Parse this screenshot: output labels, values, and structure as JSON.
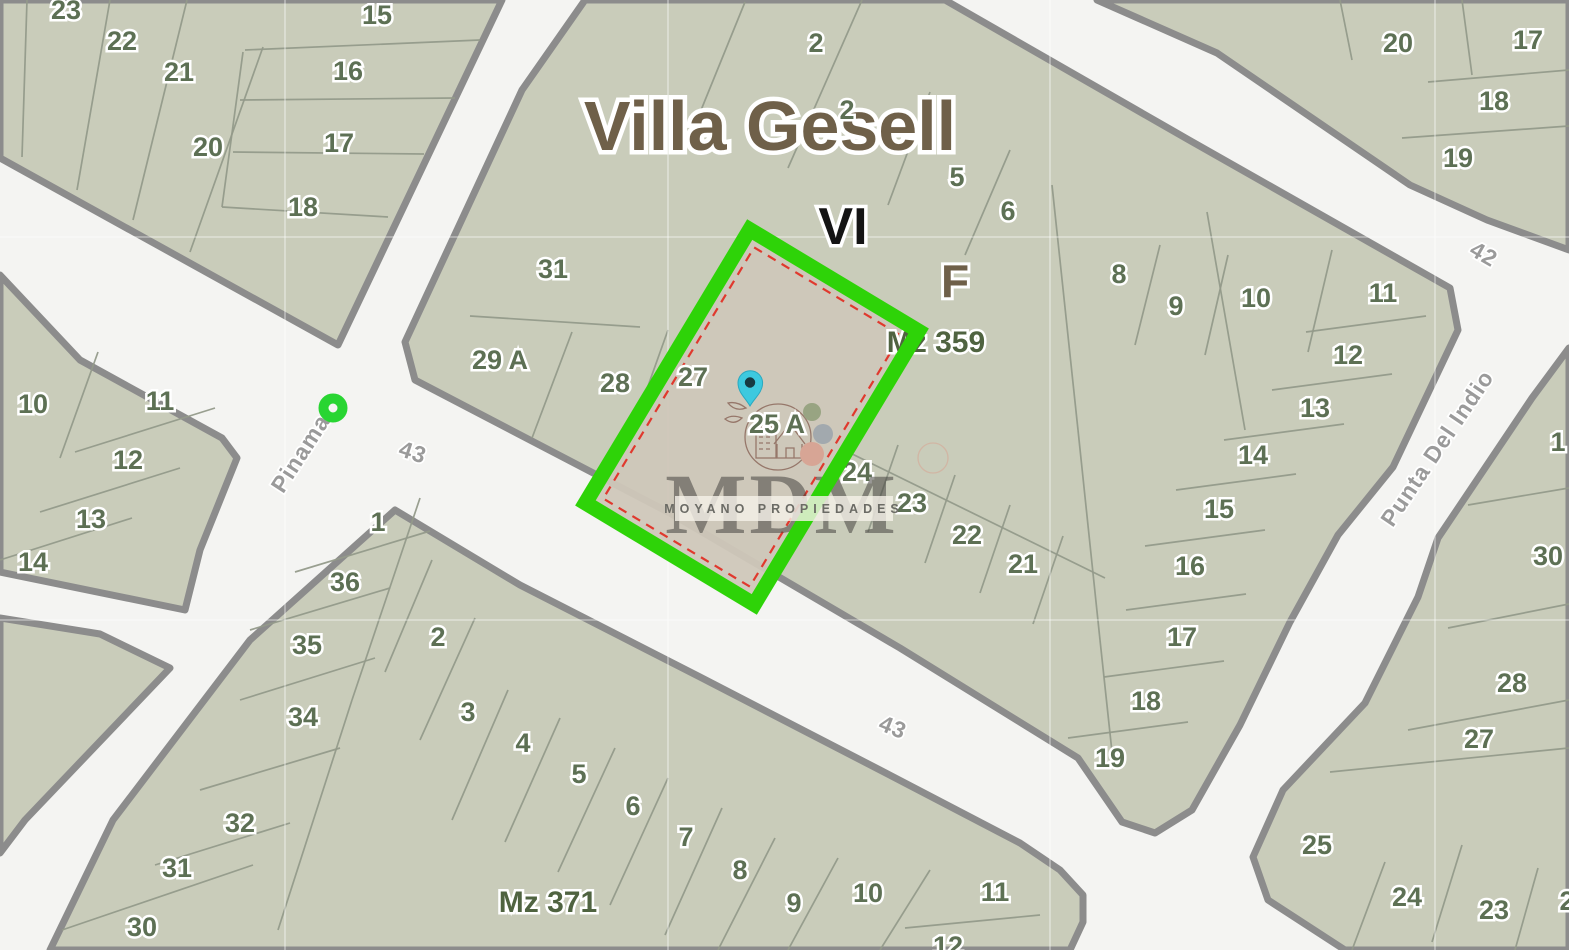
{
  "map": {
    "title": "Villa Gesell",
    "section_label": "VI",
    "subsection_label": "F",
    "block_labels": [
      {
        "text": "Mz 359",
        "x": 936,
        "y": 341
      },
      {
        "text": "Mz 371",
        "x": 548,
        "y": 901
      }
    ],
    "streets": [
      {
        "name": "Pinamar",
        "x": 303,
        "y": 449,
        "rot": -57
      },
      {
        "name": "43",
        "x": 413,
        "y": 452,
        "rot": 18
      },
      {
        "name": "43",
        "x": 893,
        "y": 727,
        "rot": 22
      },
      {
        "name": "42",
        "x": 1484,
        "y": 254,
        "rot": 30
      },
      {
        "name": "Punta Del Indio",
        "x": 1437,
        "y": 448,
        "rot": -56
      }
    ],
    "lots": [
      {
        "n": "23",
        "x": 66,
        "y": 10
      },
      {
        "n": "22",
        "x": 122,
        "y": 41
      },
      {
        "n": "21",
        "x": 179,
        "y": 72
      },
      {
        "n": "20",
        "x": 208,
        "y": 147
      },
      {
        "n": "18",
        "x": 303,
        "y": 207
      },
      {
        "n": "15",
        "x": 377,
        "y": 15
      },
      {
        "n": "16",
        "x": 348,
        "y": 71
      },
      {
        "n": "17",
        "x": 339,
        "y": 143
      },
      {
        "n": "20",
        "x": 1398,
        "y": 43
      },
      {
        "n": "17",
        "x": 1528,
        "y": 40
      },
      {
        "n": "18",
        "x": 1494,
        "y": 101
      },
      {
        "n": "19",
        "x": 1458,
        "y": 158
      },
      {
        "n": "2",
        "x": 816,
        "y": 43
      },
      {
        "n": "2",
        "x": 847,
        "y": 110
      },
      {
        "n": "5",
        "x": 957,
        "y": 177
      },
      {
        "n": "6",
        "x": 1008,
        "y": 211
      },
      {
        "n": "31",
        "x": 553,
        "y": 269
      },
      {
        "n": "29 A",
        "x": 500,
        "y": 360
      },
      {
        "n": "28",
        "x": 615,
        "y": 383
      },
      {
        "n": "27",
        "x": 693,
        "y": 377
      },
      {
        "n": "25 A",
        "x": 777,
        "y": 424
      },
      {
        "n": "24",
        "x": 857,
        "y": 472
      },
      {
        "n": "23",
        "x": 912,
        "y": 503
      },
      {
        "n": "22",
        "x": 967,
        "y": 535
      },
      {
        "n": "21",
        "x": 1023,
        "y": 564
      },
      {
        "n": "8",
        "x": 1119,
        "y": 274
      },
      {
        "n": "9",
        "x": 1176,
        "y": 306
      },
      {
        "n": "10",
        "x": 1256,
        "y": 298
      },
      {
        "n": "11",
        "x": 1383,
        "y": 293
      },
      {
        "n": "12",
        "x": 1348,
        "y": 355
      },
      {
        "n": "13",
        "x": 1315,
        "y": 408
      },
      {
        "n": "14",
        "x": 1253,
        "y": 455
      },
      {
        "n": "15",
        "x": 1219,
        "y": 509
      },
      {
        "n": "16",
        "x": 1190,
        "y": 566
      },
      {
        "n": "17",
        "x": 1182,
        "y": 637
      },
      {
        "n": "18",
        "x": 1146,
        "y": 701
      },
      {
        "n": "19",
        "x": 1110,
        "y": 758
      },
      {
        "n": "10",
        "x": 33,
        "y": 404
      },
      {
        "n": "11",
        "x": 160,
        "y": 401
      },
      {
        "n": "12",
        "x": 128,
        "y": 460
      },
      {
        "n": "13",
        "x": 91,
        "y": 519
      },
      {
        "n": "14",
        "x": 33,
        "y": 562
      },
      {
        "n": "1",
        "x": 378,
        "y": 522
      },
      {
        "n": "36",
        "x": 345,
        "y": 582
      },
      {
        "n": "2",
        "x": 438,
        "y": 637
      },
      {
        "n": "35",
        "x": 307,
        "y": 645
      },
      {
        "n": "3",
        "x": 468,
        "y": 712
      },
      {
        "n": "34",
        "x": 303,
        "y": 717
      },
      {
        "n": "4",
        "x": 523,
        "y": 743
      },
      {
        "n": "5",
        "x": 579,
        "y": 774
      },
      {
        "n": "6",
        "x": 633,
        "y": 806
      },
      {
        "n": "32",
        "x": 240,
        "y": 823
      },
      {
        "n": "7",
        "x": 686,
        "y": 837
      },
      {
        "n": "31",
        "x": 177,
        "y": 868
      },
      {
        "n": "8",
        "x": 740,
        "y": 870
      },
      {
        "n": "9",
        "x": 794,
        "y": 903
      },
      {
        "n": "30",
        "x": 142,
        "y": 927
      },
      {
        "n": "10",
        "x": 868,
        "y": 893
      },
      {
        "n": "11",
        "x": 995,
        "y": 892
      },
      {
        "n": "12",
        "x": 948,
        "y": 946
      },
      {
        "n": "1",
        "x": 1558,
        "y": 442
      },
      {
        "n": "30",
        "x": 1548,
        "y": 556
      },
      {
        "n": "28",
        "x": 1512,
        "y": 683
      },
      {
        "n": "27",
        "x": 1479,
        "y": 739
      },
      {
        "n": "25",
        "x": 1317,
        "y": 845
      },
      {
        "n": "24",
        "x": 1407,
        "y": 897
      },
      {
        "n": "23",
        "x": 1494,
        "y": 910
      },
      {
        "n": "2",
        "x": 1567,
        "y": 901
      }
    ],
    "colors": {
      "street_bg": "#f4f4f2",
      "block_fill": "#c9ccba",
      "block_edge": "#8c8c8c",
      "lot_number": "#5d7054",
      "title_brown": "#6f6049",
      "mz_green": "#4f6340",
      "highlight_green": "#2ed308",
      "corner_marker_green": "#28d532",
      "highlight_fill": "#cfc7b9",
      "boundary_red": "#e0392e",
      "pin_teal": "#3dc9df",
      "watermark_brown": "#8d6a5d"
    }
  },
  "watermark": {
    "logo_text": "MDM",
    "subtitle": "MOYANO PROPIEDADES"
  }
}
